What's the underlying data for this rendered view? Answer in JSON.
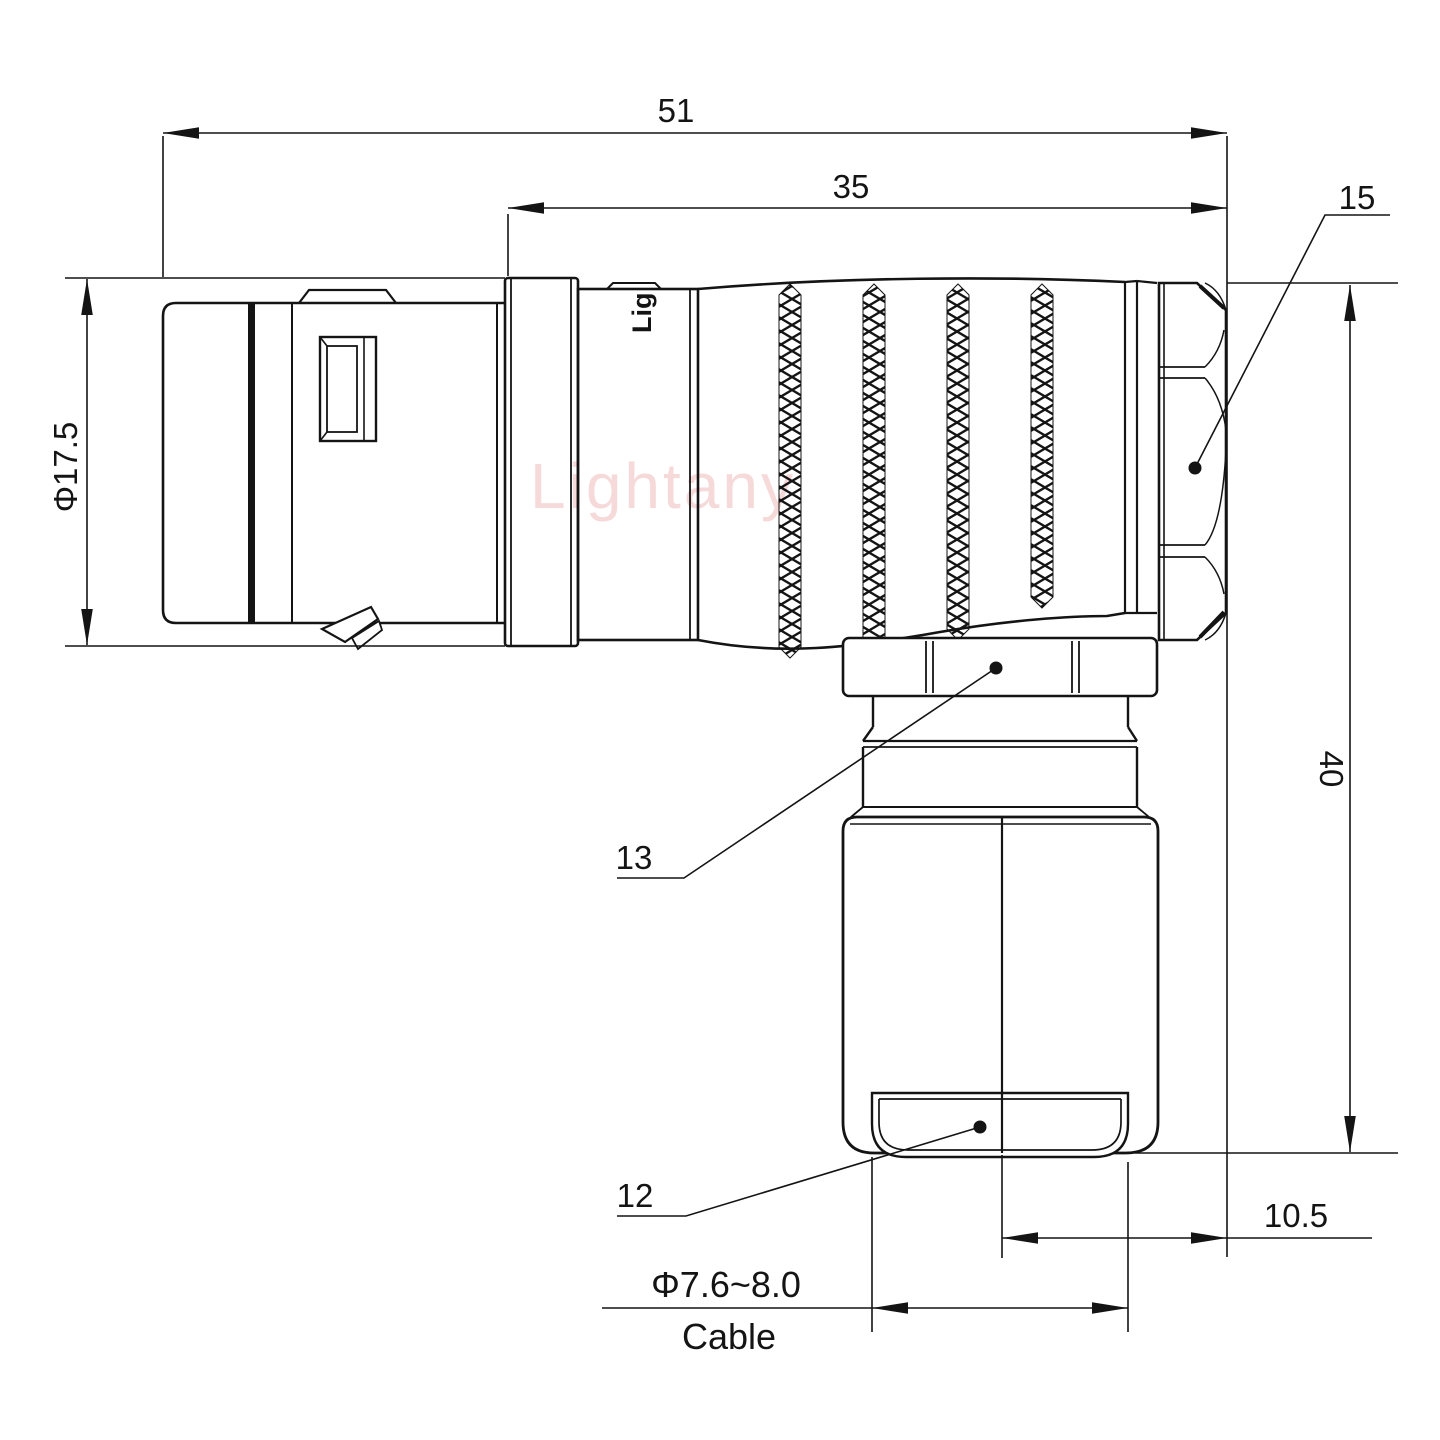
{
  "drawing": {
    "watermark": "Lightany",
    "body_logo": "Lig",
    "dims": {
      "overall_length": "51",
      "rear_length": "35",
      "front_diameter": "Φ17.5",
      "height": "40",
      "exit_offset": "10.5",
      "cable_diameter": "Φ7.6~8.0",
      "cable_word": "Cable"
    },
    "parts": {
      "back_nut": "15",
      "coupling_nut": "13",
      "cable_bushing": "12"
    },
    "colors": {
      "line": "#141414",
      "watermark": "#efb5b5",
      "background": "#ffffff"
    }
  }
}
